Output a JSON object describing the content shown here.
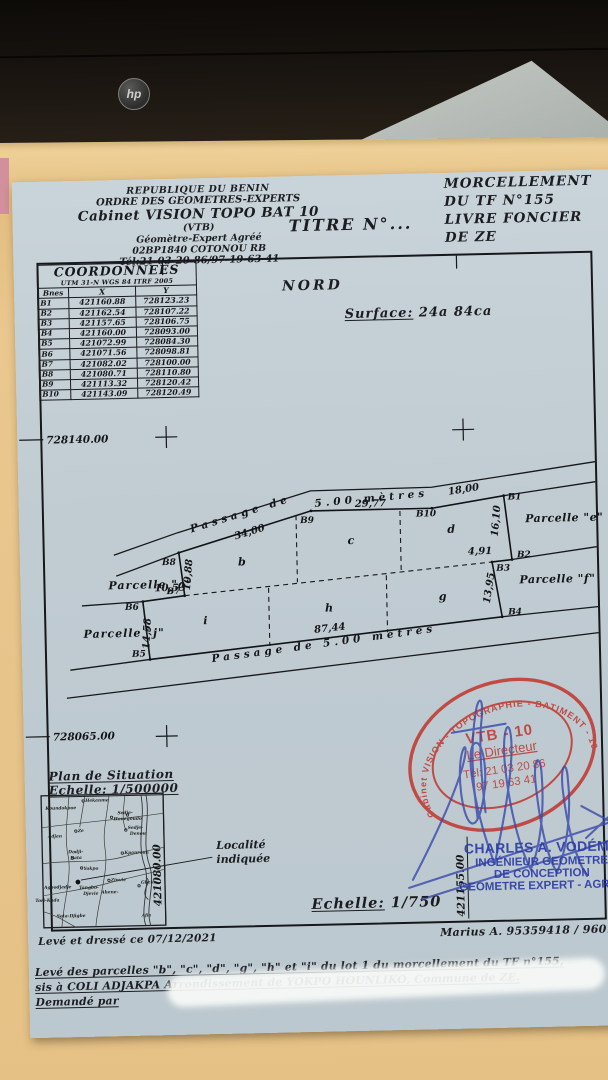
{
  "header": {
    "line1": "REPUBLIQUE DU BENIN",
    "line2": "ORDRE DES GEOMETRES-EXPERTS",
    "line3": "Cabinet VISION TOPO BAT 10",
    "line4": "(VTB)",
    "line5": "Géomètre-Expert Agréé",
    "line6": "02BP1840 COTONOU RB",
    "line7": "Tél:21-03-20-86/97-19-63-41",
    "titre": "TITRE N°...",
    "right1": "MORCELLEMENT",
    "right2": "DU TF N°155",
    "right3": "LIVRE FONCIER",
    "right4": "DE ZE"
  },
  "coordinates": {
    "title": "COORDONNEES",
    "subtitle": "UTM 31-N WGS 84 ITRF 2005",
    "columns": [
      "Bnes",
      "X",
      "Y"
    ],
    "rows": [
      [
        "B1",
        "421160.88",
        "728123.23"
      ],
      [
        "B2",
        "421162.54",
        "728107.22"
      ],
      [
        "B3",
        "421157.65",
        "728106.75"
      ],
      [
        "B4",
        "421160.00",
        "728093.00"
      ],
      [
        "B5",
        "421072.99",
        "728084.30"
      ],
      [
        "B6",
        "421071.56",
        "728098.81"
      ],
      [
        "B7",
        "421082.02",
        "728100.00"
      ],
      [
        "B8",
        "421080.71",
        "728110.80"
      ],
      [
        "B9",
        "421113.32",
        "728120.42"
      ],
      [
        "B10",
        "421143.09",
        "728120.49"
      ]
    ]
  },
  "plan": {
    "north_label": "NORD",
    "surface_label": "Surface:",
    "surface_value": "24a 84ca",
    "grid": {
      "y_top": "728140.00",
      "y_bottom": "728065.00",
      "x_left": "421080.00",
      "x_right": "421155.00"
    },
    "points": {
      "B1": "B1",
      "B2": "B2",
      "B3": "B3",
      "B4": "B4",
      "B5": "B5",
      "B6": "B6",
      "B7": "B7",
      "B8": "B8",
      "B9": "B9",
      "B10": "B10"
    },
    "dims": {
      "b8_b9": "34,00",
      "b9_b10": "29,77",
      "b10_b1": "18,00",
      "b1_b2": "16,10",
      "b2_b3": "4,91",
      "b3_b4": "13,95",
      "b4_b5": "87,44",
      "b5_b6": "14,58",
      "b6_b7": "10,53",
      "b7_b8": "10,88"
    },
    "parcels": {
      "a": "Parcelle \"a\"",
      "j": "Parcelle \"j\"",
      "e": "Parcelle \"e\"",
      "f": "Parcelle \"f\"",
      "b": "b",
      "c": "c",
      "d": "d",
      "g": "g",
      "h": "h",
      "i": "i"
    },
    "road_top_1": "Passage de",
    "road_top_2": "5.00 mètres",
    "road_bottom": "Passage de 5.00 mètres"
  },
  "stamp": {
    "ring": "Cabinet VISION - TOPOGRAPHIE - BATIMENT - 10",
    "line1": "VTB - 10",
    "line2": "Le Directeur",
    "line3": "Tél: 21 03 20 86",
    "line4": "97 19 63 41"
  },
  "signature_block": {
    "name": "CHARLES A. VODÉME",
    "line2": "INGÉNIEUR GEOMETRE",
    "line3": "DE CONCEPTION",
    "line4": "GEOMETRE EXPERT - AGRÉE"
  },
  "situation": {
    "title": "Plan de Situation",
    "scale": "Echelle: 1/500000",
    "locality_1": "Localité",
    "locality_2": "indiquée",
    "places": [
      "Koundokpoe",
      "Hekanme",
      "Sedje-",
      "Houegoudo",
      "Ze",
      "Adjan",
      "Sedje-",
      "Denou",
      "Dodji-",
      "Bata",
      "Kpanroun",
      "Yokpo",
      "Zinvie",
      "Gbeko",
      "Tangbo-",
      "Djevie",
      "Ahene-",
      "Agbodjedje",
      "Tori-Kada",
      "Sota-Djigbe",
      "Afia"
    ]
  },
  "scale_main_label": "Echelle:",
  "scale_main_value": "1/750",
  "footer": {
    "dressed": "Levé et dressé ce 07/12/2021",
    "ref": "Marius A. 95359418 / 9601853",
    "line1": "Levé des parcelles \"b\", \"c\", \"d\", \"g\", \"h\" et \"i\" du lot 1 du morcellement du TF n°155,",
    "line2": "sis à COLI ADJAKPA  Arrondissement de YOKPO HOUNLIKO, Commune de ZE.",
    "line3": "Demandé par"
  },
  "photo": {
    "hp_logo": "hp"
  }
}
